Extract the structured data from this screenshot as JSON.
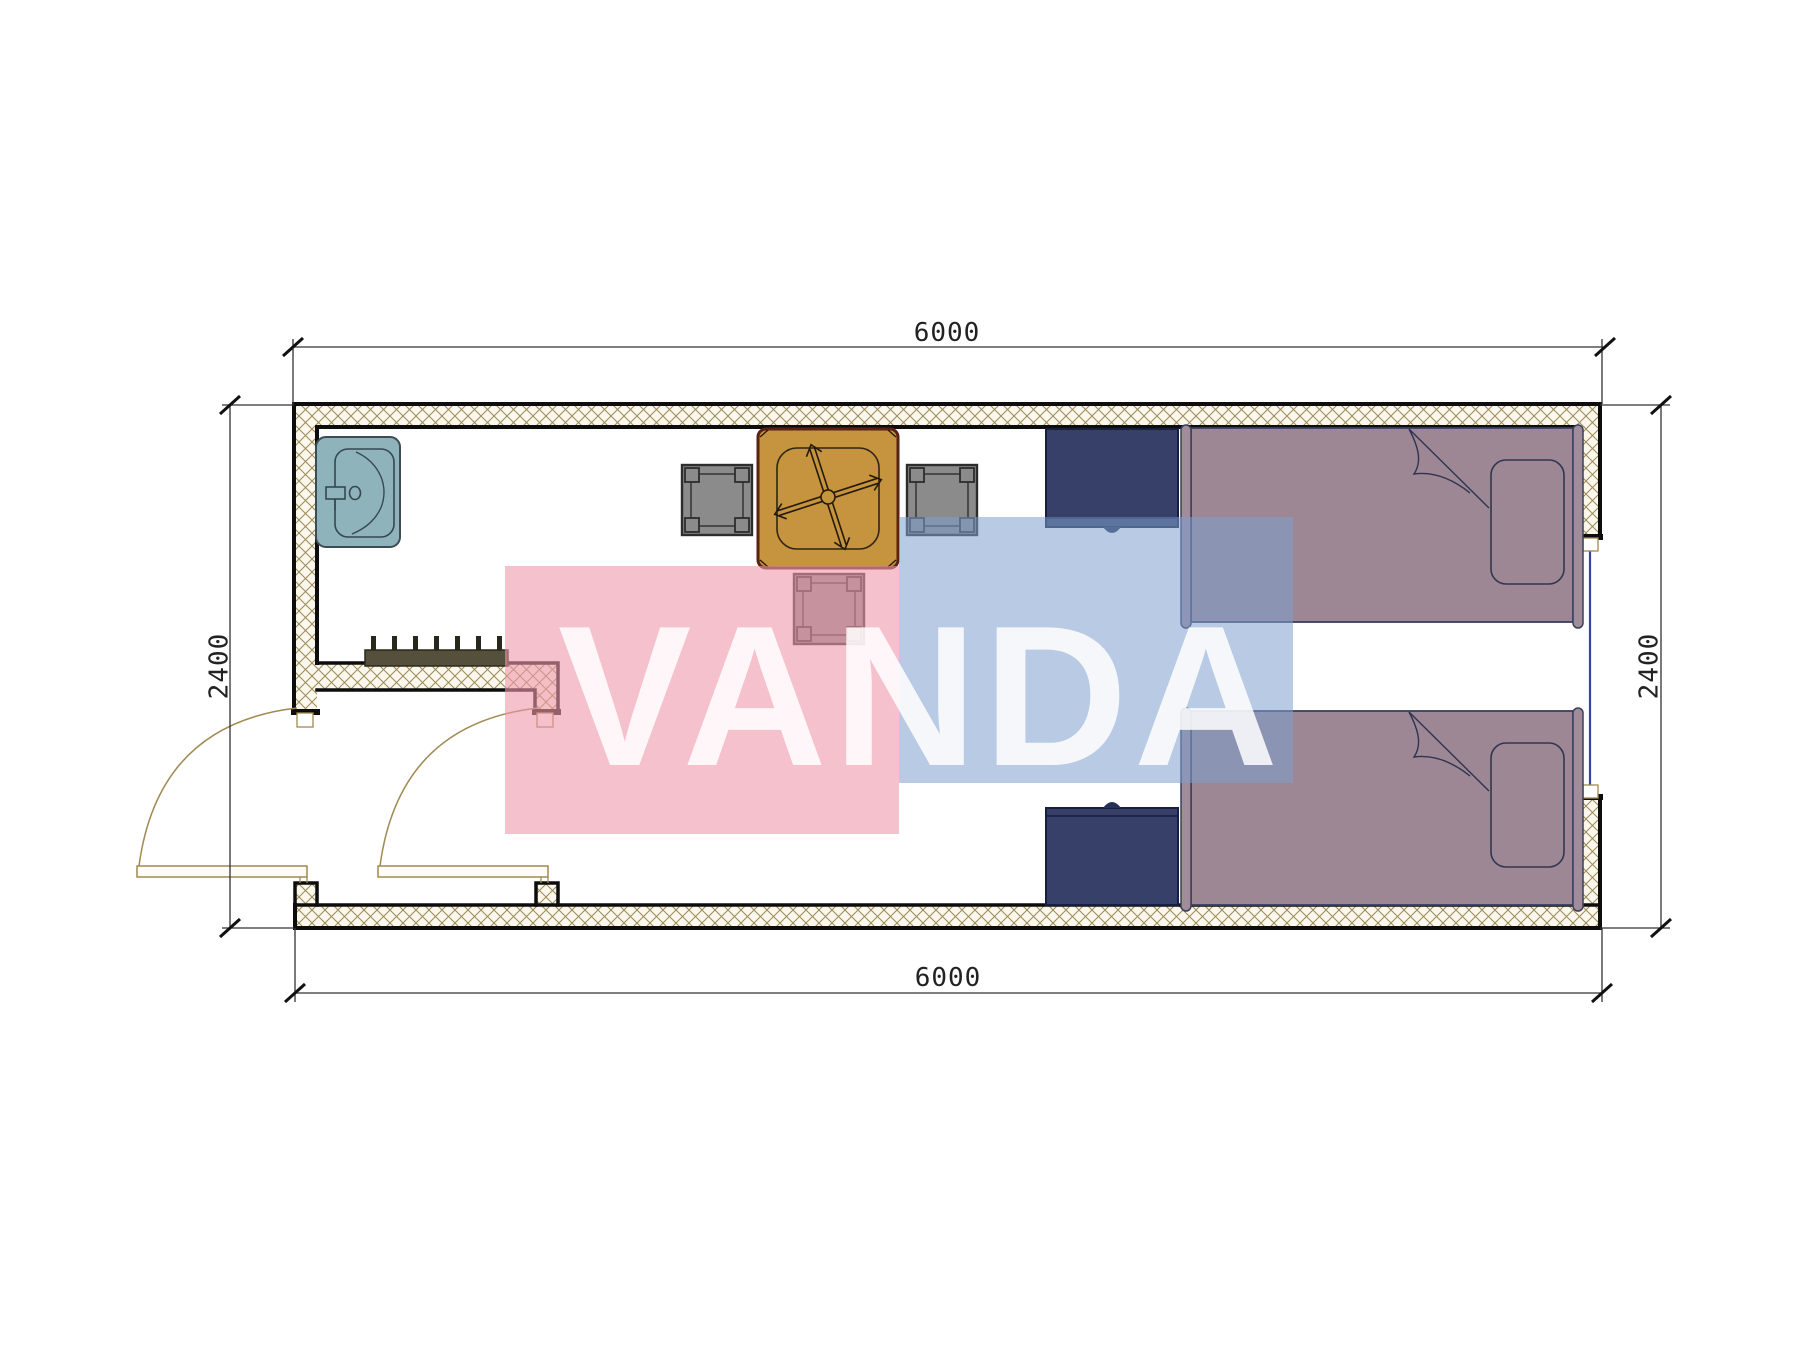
{
  "drawing": {
    "type": "floor-plan",
    "room_outer_width_label": "6000",
    "room_outer_depth_label": "2400"
  },
  "dimensions": {
    "top": "6000",
    "bottom": "6000",
    "left": "2400",
    "right": "2400"
  },
  "watermark": {
    "text": "VANDA",
    "pink": "#ee98aa",
    "blue": "#7d9ecd"
  },
  "colors": {
    "wall_fill": "#fbf7ec",
    "wall_hatch_line": "#9b8a58",
    "wall_border": "#0d0d0d",
    "dim_line": "#333333",
    "sink": "#8fb3ba",
    "sink_stroke": "#3d4b52",
    "table": "#c6933e",
    "table_stroke": "#5a2212",
    "stool": "#8b8b8b",
    "stool_stroke": "#2d2d2d",
    "cabinet": "#364069",
    "cabinet_stroke": "#161f40",
    "bed": "#9d8795",
    "bed_bar": "#a18c9a",
    "bed_stroke": "#39405f",
    "door": "#a08a52",
    "window_glass": "#37479e",
    "coat_rack": "#54503c"
  },
  "legend": [
    "wash-basin",
    "coat-rack-7-hooks",
    "square-dining-table",
    "stool-left",
    "stool-right",
    "stool-bottom",
    "nightstand-top",
    "nightstand-bottom",
    "single-bed-top",
    "single-bed-bottom",
    "entry-door",
    "vestibule-door",
    "window-right-wall"
  ]
}
